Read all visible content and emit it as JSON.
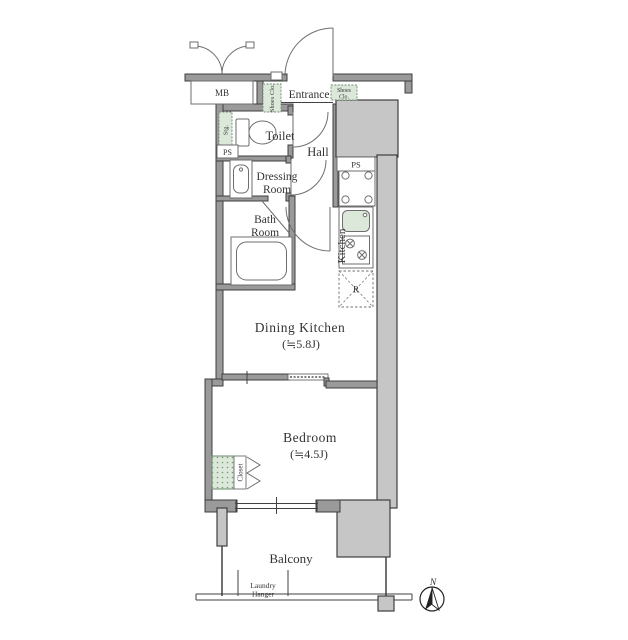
{
  "colors": {
    "wall_outline": "#3f3f3f",
    "wall_fill_gray": "#c6c6c6",
    "wall_fill_mid": "#9a9a9a",
    "closet_green": "#dce8da",
    "closet_green_border": "#6c8c6c",
    "text": "#333333"
  },
  "plan": {
    "mb_label": "MB",
    "entrance_label": "Entrance",
    "shoes_closet_left_label": "Shoes Clo.",
    "shoes_closet_right_line1": "Shoes",
    "shoes_closet_right_line2": "Clo.",
    "storage_label": "Stg.",
    "ps_left_label": "PS",
    "ps_right_label": "PS",
    "toilet_label": "Toilet",
    "hall_label": "Hall",
    "dressing_room_line1": "Dressing",
    "dressing_room_line2": "Room",
    "bath_room_line1": "Bath",
    "bath_room_line2": "Room",
    "kitchen_label": "Kitchen",
    "refrigerator_label": "R",
    "dining_kitchen_label": "Dining Kitchen",
    "dining_kitchen_size": "(≒5.8J)",
    "bedroom_label": "Bedroom",
    "bedroom_size": "(≒4.5J)",
    "closet_label": "Closet",
    "balcony_label": "Balcony",
    "laundry_hanger_line1": "Laundry",
    "laundry_hanger_line2": "Hanger",
    "north_label": "N"
  }
}
